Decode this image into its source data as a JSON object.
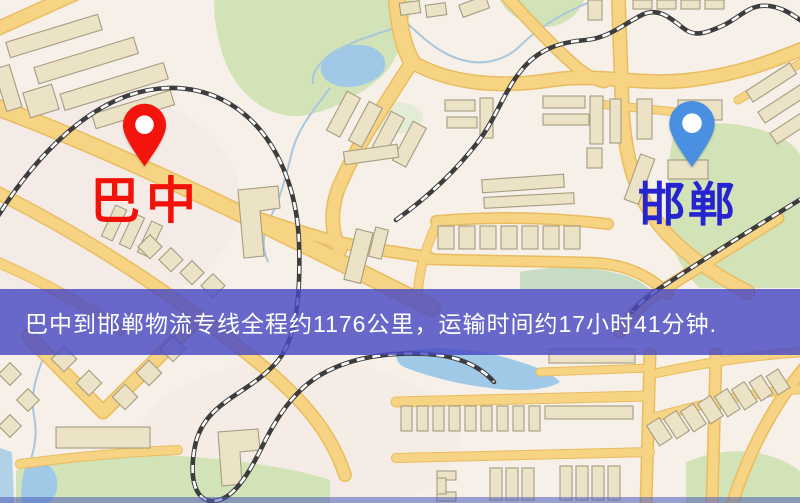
{
  "banner": {
    "text": "巴中到邯郸物流专线全程约1176公里，运输时间约17小时41分钟.",
    "background_color": "#4849c3",
    "text_color": "#ffffff"
  },
  "origin": {
    "name": "巴中",
    "marker_color": "#f3140b",
    "label_color": "#f3120a"
  },
  "destination": {
    "name": "邯郸",
    "marker_color": "#4a90e2",
    "label_color": "#2524ce"
  },
  "route_summary": {
    "from": "巴中",
    "to": "邯郸",
    "distance_km": "1176",
    "duration": "17小时41分钟"
  },
  "map_palette": {
    "background": "#f6f0e8",
    "road": "#f6d483",
    "road_casing": "#e9bc60",
    "building_fill": "#ece2c6",
    "building_stroke": "#a59c82",
    "park": "#d2e3b8",
    "water": "#9fc9e6",
    "railway": "#3d3d3d"
  }
}
